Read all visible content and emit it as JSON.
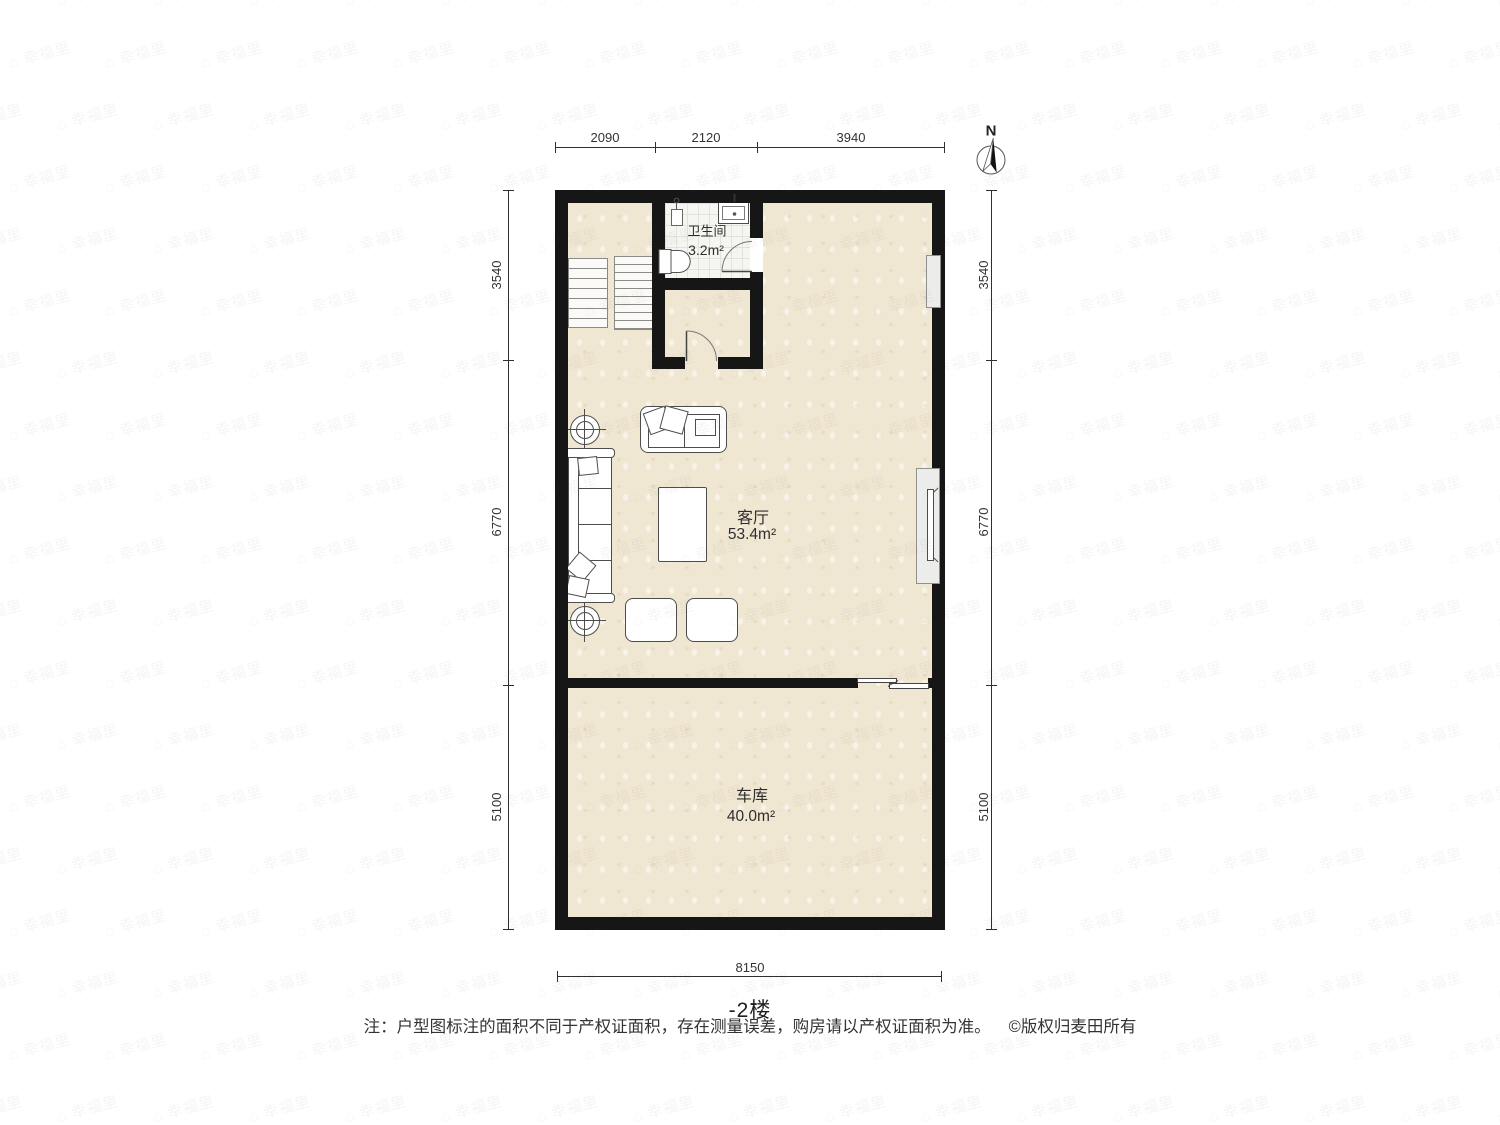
{
  "meta": {
    "floor_title": "-2楼",
    "note": "注：户型图标注的面积不同于产权证面积，存在测量误差，购房请以产权证面积为准。",
    "copyright": "©版权归麦田所有",
    "watermark_text": "幸福里",
    "north_label": "N"
  },
  "rooms": {
    "bathroom": {
      "name": "卫生间",
      "area": "3.2m²"
    },
    "living": {
      "name": "客厅",
      "area": "53.4m²"
    },
    "garage": {
      "name": "车库",
      "area": "40.0m²"
    }
  },
  "dimensions": {
    "top": {
      "segments": [
        "2090",
        "2120",
        "3940"
      ]
    },
    "left": {
      "segments": [
        "3540",
        "6770",
        "5100"
      ]
    },
    "right": {
      "segments": [
        "3540",
        "6770",
        "5100"
      ]
    },
    "bottom": {
      "segments": [
        "8150"
      ]
    }
  },
  "colors": {
    "wall": "#161616",
    "floor": "#f0e7d3",
    "bathroom_tile": "#f5f5f1",
    "line": "#333333"
  }
}
